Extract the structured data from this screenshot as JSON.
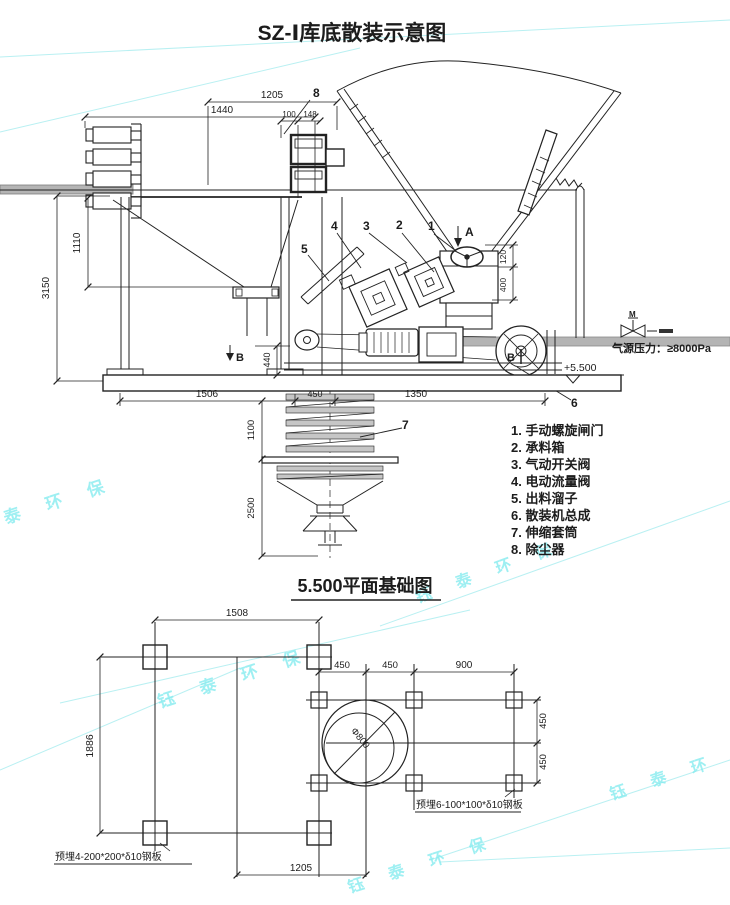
{
  "watermark": {
    "color": "#86ecef",
    "instances": [
      "泰 环 保",
      "钰 泰 环 保",
      "钰 泰 环 保",
      "钰 泰 环 保",
      "钰 泰 环 保"
    ]
  },
  "schematic": {
    "title": "SZ-Ⅰ库底散装示意图",
    "pressure_note": "气源压力：≥8000Pa",
    "level_label": "+5.500",
    "motor_label": "M",
    "section": {
      "a": "A",
      "b_left": "B",
      "b_right": "B"
    },
    "callouts": {
      "c1": "1",
      "c2": "2",
      "c3": "3",
      "c4": "4",
      "c5": "5",
      "c6": "6",
      "c7": "7",
      "c8": "8"
    },
    "dims": {
      "w1205": "1205",
      "w1440": "1440",
      "w100": "100",
      "w148": "148",
      "v3150": "3150",
      "v1110": "1110",
      "v440": "440",
      "v1100": "1100",
      "v2500": "2500",
      "w1506": "1506",
      "w450": "450",
      "w1350": "1350",
      "v120": "120",
      "v400": "400"
    },
    "legend": {
      "items": [
        "1. 手动螺旋闸门",
        "2. 承料箱",
        "3. 气动开关阀",
        "4. 电动流量阀",
        "5. 出料溜子",
        "6. 散装机总成",
        "7. 伸缩套筒",
        "8. 除尘器"
      ]
    }
  },
  "foundation": {
    "title": "5.500平面基础图",
    "dims": {
      "w1508": "1508",
      "v1886": "1886",
      "w1205": "1205",
      "w450a": "450",
      "w450b": "450",
      "w900": "900",
      "v450a": "450",
      "v450b": "450",
      "circle": "Φ800"
    },
    "notes": {
      "plate4": "预埋4-200*200*δ10钢板",
      "plate6": "预埋6-100*100*δ10钢板"
    }
  }
}
